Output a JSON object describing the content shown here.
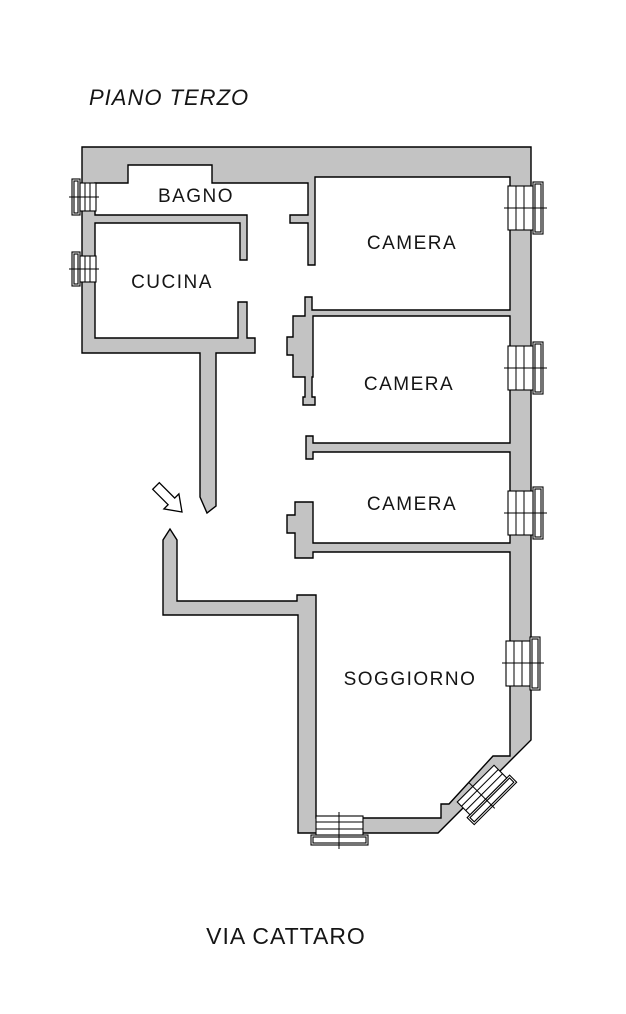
{
  "title": "PIANO TERZO",
  "street": "VIA CATTARO",
  "rooms": [
    {
      "name": "BAGNO"
    },
    {
      "name": "CUCINA"
    },
    {
      "name": "CAMERA"
    },
    {
      "name": "CAMERA"
    },
    {
      "name": "CAMERA"
    },
    {
      "name": "SOGGIORNO"
    }
  ],
  "windows": [
    {
      "name": "bagno-window",
      "wall": "left"
    },
    {
      "name": "cucina-window",
      "wall": "left"
    },
    {
      "name": "camera-1-window",
      "wall": "right"
    },
    {
      "name": "camera-2-window",
      "wall": "right"
    },
    {
      "name": "camera-3-window",
      "wall": "right"
    },
    {
      "name": "soggiorno-side-window",
      "wall": "right"
    },
    {
      "name": "soggiorno-bottom-window",
      "wall": "bottom"
    },
    {
      "name": "soggiorno-diagonal-window",
      "wall": "diagonal"
    }
  ],
  "icons": [
    {
      "name": "entrance-arrow-icon",
      "meaning": "entrance direction into hallway"
    }
  ],
  "colors": {
    "wall_fill": "#c3c3c3",
    "outline": "#000000",
    "background": "#ffffff",
    "text": "#151515"
  }
}
